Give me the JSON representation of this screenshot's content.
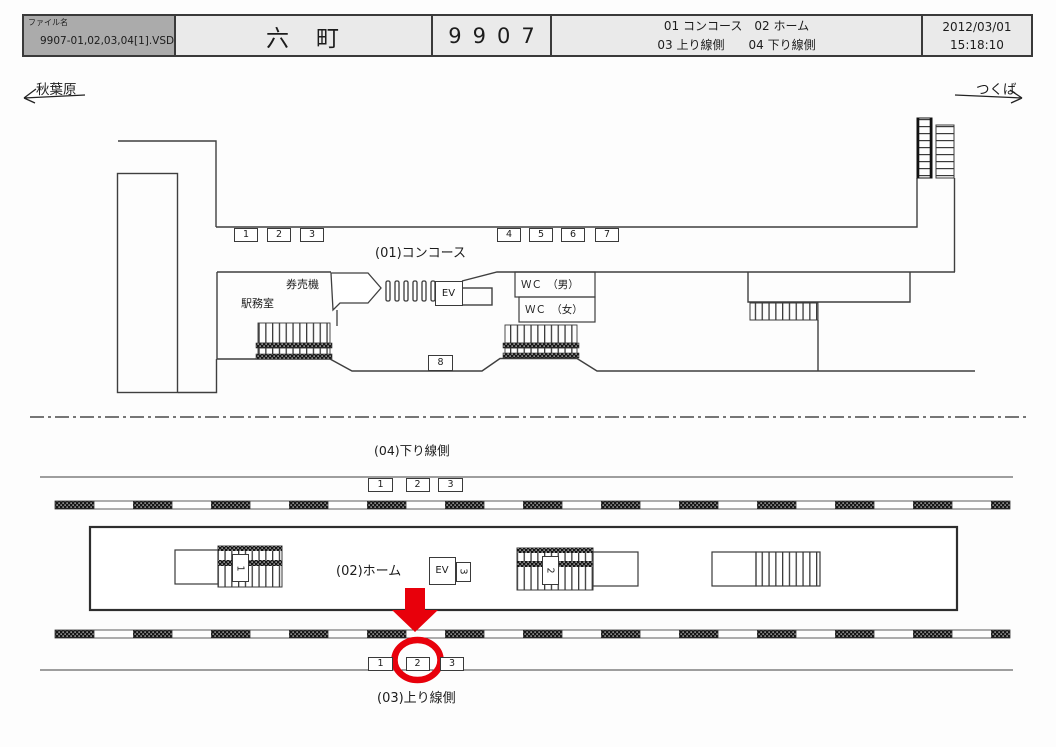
{
  "header": {
    "file_label": "ファイル名",
    "file_name": "9907-01,02,03,04[1].VSD",
    "station_name": "六　町",
    "diagram_number": "9907",
    "legend_line1": "01 コンコース　02 ホーム",
    "legend_line2": "03 上り線側　　04 下り線側",
    "date": "2012/03/01",
    "time": "15:18:10"
  },
  "directions": {
    "left_station": "秋葉原",
    "right_station": "つくば"
  },
  "concourse": {
    "title": "(01)コンコース",
    "sign_numbers": [
      "1",
      "2",
      "3",
      "4",
      "5",
      "6",
      "7"
    ],
    "sign_8": "8",
    "ticket_machines_label": "券売機",
    "station_office_label": "駅務室",
    "elevator_label": "EV",
    "wc_men_label": "ＷＣ　（男）",
    "wc_women_label": "ＷＣ　（女）"
  },
  "down_line_side": {
    "title": "(04)下り線側",
    "sign_numbers": [
      "1",
      "2",
      "3"
    ]
  },
  "platform": {
    "title": "(02)ホーム",
    "elevator_label": "EV",
    "stair_sign_left": "1",
    "stair_sign_ev": "3",
    "stair_sign_middle": "2"
  },
  "up_line_side": {
    "title": "(03)上り線側",
    "sign_numbers": [
      "1",
      "2",
      "3"
    ]
  },
  "highlight": {
    "highlighted_sign": "2",
    "color": "#e8000b"
  },
  "colors": {
    "line": "#3f3f3f",
    "header_fill": "#eaeaea",
    "filename_fill": "#ababab",
    "red": "#e8000b"
  }
}
